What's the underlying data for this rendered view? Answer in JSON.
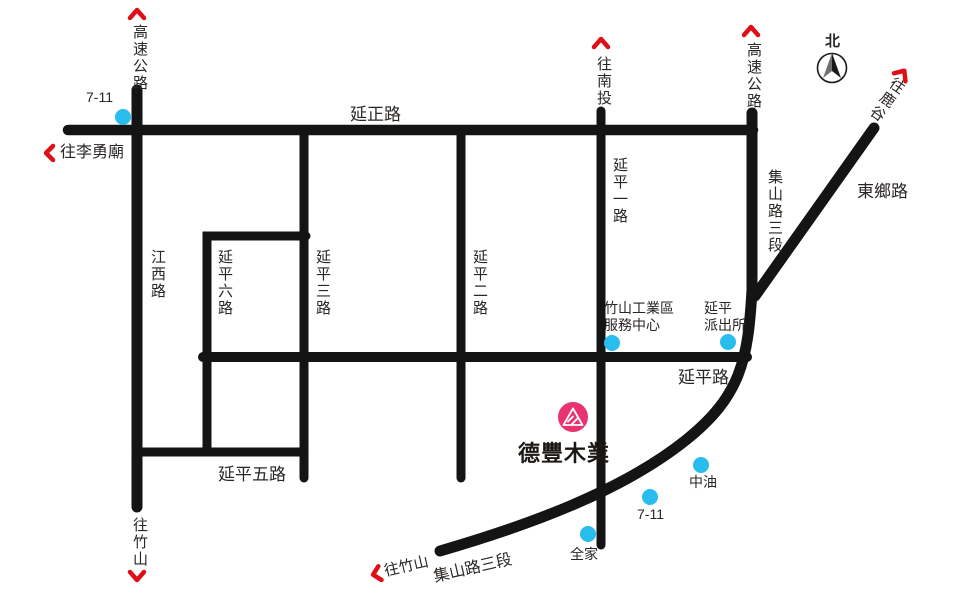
{
  "colors": {
    "road": "#141414",
    "text": "#2a2624",
    "poi": "#29bdee",
    "red": "#df0f18",
    "pink": "#e8336e",
    "compass_dark": "#1a1a1a",
    "compass_light": "#707070",
    "white": "#ffffff"
  },
  "brand": {
    "name": "德豐木業"
  },
  "compass": {
    "north_label": "北"
  },
  "roads": {
    "highway_left": "高速公路",
    "highway_right": "高速公路",
    "yanzheng": "延正路",
    "jiangxi": "江西路",
    "yanping_1": "延平一路",
    "yanping_2": "延平二路",
    "yanping_3": "延平三路",
    "yanping_5": "延平五路",
    "yanping_6": "延平六路",
    "yanping": "延平路",
    "jishan_right": "集山路三段",
    "jishan_bottom": "集山路三段",
    "dongxiang": "東鄉路"
  },
  "directions": {
    "nantou": "往南投",
    "lugu": "往鹿谷",
    "liyong_temple": "往李勇廟",
    "zhushan_west": "往竹山",
    "zhushan_south": "往竹山"
  },
  "pois": {
    "seven_eleven_north": "7-11",
    "seven_eleven_south": "7-11",
    "cpc": "中油",
    "family_mart": "全家",
    "service_center_line1": "竹山工業區",
    "service_center_line2": "服務中心",
    "police_line1": "延平",
    "police_line2": "派出所"
  }
}
